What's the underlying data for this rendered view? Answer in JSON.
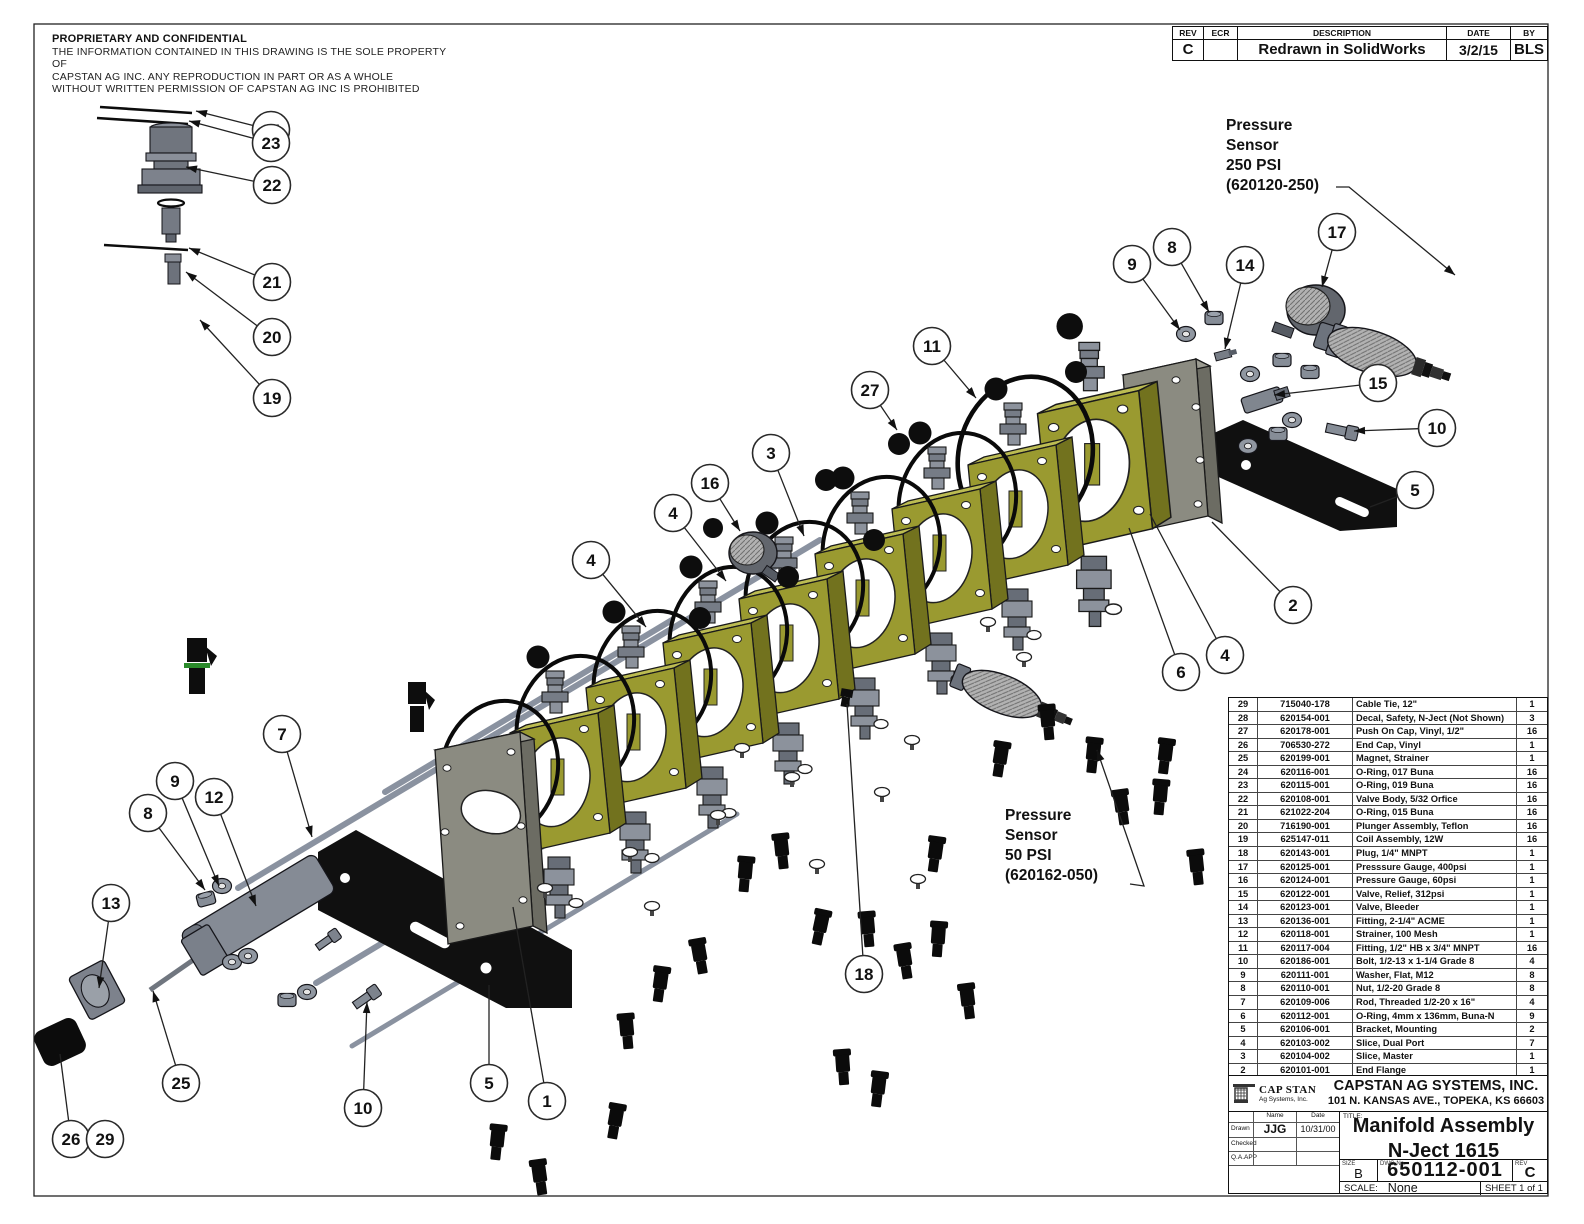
{
  "sheet": {
    "proprietary": {
      "title": "PROPRIETARY AND CONFIDENTIAL",
      "line1": "THE INFORMATION CONTAINED IN THIS DRAWING IS THE SOLE PROPERTY OF",
      "line2": "CAPSTAN AG INC. ANY REPRODUCTION IN PART OR AS A WHOLE",
      "line3": "WITHOUT WRITTEN PERMISSION OF CAPSTAN AG INC IS PROHIBITED"
    },
    "revision_table": {
      "headers": [
        "REV",
        "ECR",
        "DESCRIPTION",
        "DATE",
        "BY"
      ],
      "row": {
        "rev": "C",
        "ecr": "",
        "description": "Redrawn in SolidWorks",
        "date": "3/2/15",
        "by": "BLS"
      }
    },
    "labels": {
      "pressure_250": [
        "Pressure",
        "Sensor",
        "250 PSI",
        "(620120-250)"
      ],
      "pressure_50": [
        "Pressure",
        "Sensor",
        "50 PSI",
        "(620162-050)"
      ]
    },
    "bom": {
      "headers": [
        "Item",
        "Part Number",
        "Description",
        "Qty"
      ],
      "rows": [
        [
          "29",
          "715040-178",
          "Cable Tie, 12\"",
          "1"
        ],
        [
          "28",
          "620154-001",
          "Decal, Safety, N-Ject (Not Shown)",
          "3"
        ],
        [
          "27",
          "620178-001",
          "Push On Cap, Vinyl, 1/2\"",
          "16"
        ],
        [
          "26",
          "706530-272",
          "End Cap, Vinyl",
          "1"
        ],
        [
          "25",
          "620199-001",
          "Magnet, Strainer",
          "1"
        ],
        [
          "24",
          "620116-001",
          "O-Ring, 017 Buna",
          "16"
        ],
        [
          "23",
          "620115-001",
          "O-Ring, 019 Buna",
          "16"
        ],
        [
          "22",
          "620108-001",
          "Valve Body, 5/32 Orfice",
          "16"
        ],
        [
          "21",
          "621022-204",
          "O-Ring, 015 Buna",
          "16"
        ],
        [
          "20",
          "716190-001",
          "Plunger Assembly, Teflon",
          "16"
        ],
        [
          "19",
          "625147-011",
          "Coil Assembly, 12W",
          "16"
        ],
        [
          "18",
          "620143-001",
          "Plug, 1/4\" MNPT",
          "1"
        ],
        [
          "17",
          "620125-001",
          "Presssure Gauge, 400psi",
          "1"
        ],
        [
          "16",
          "620124-001",
          "Pressure Gauge, 60psi",
          "1"
        ],
        [
          "15",
          "620122-001",
          "Valve, Relief, 312psi",
          "1"
        ],
        [
          "14",
          "620123-001",
          "Valve, Bleeder",
          "1"
        ],
        [
          "13",
          "620136-001",
          "Fitting, 2-1/4\" ACME",
          "1"
        ],
        [
          "12",
          "620118-001",
          "Strainer, 100 Mesh",
          "1"
        ],
        [
          "11",
          "620117-004",
          "Fitting, 1/2\" HB x 3/4\" MNPT",
          "16"
        ],
        [
          "10",
          "620186-001",
          "Bolt, 1/2-13 x 1-1/4 Grade 8",
          "4"
        ],
        [
          "9",
          "620111-001",
          "Washer, Flat, M12",
          "8"
        ],
        [
          "8",
          "620110-001",
          "Nut, 1/2-20 Grade 8",
          "8"
        ],
        [
          "7",
          "620109-006",
          "Rod, Threaded 1/2-20 x 16\"",
          "4"
        ],
        [
          "6",
          "620112-001",
          "O-Ring, 4mm x 136mm, Buna-N",
          "9"
        ],
        [
          "5",
          "620106-001",
          "Bracket, Mounting",
          "2"
        ],
        [
          "4",
          "620103-002",
          "Slice, Dual Port",
          "7"
        ],
        [
          "3",
          "620104-002",
          "Slice, Master",
          "1"
        ],
        [
          "2",
          "620101-001",
          "End Flange",
          "1"
        ],
        [
          "1",
          "620100-001",
          "Inlet Flange",
          "1"
        ]
      ]
    },
    "title_block": {
      "logo_line1": "CAP STAN",
      "logo_line2": "Ag Systems, Inc.",
      "company": "CAPSTAN AG SYSTEMS, INC.",
      "address": "101 N. KANSAS AVE., TOPEKA, KS 66603",
      "name_col": "Name",
      "date_col": "Date",
      "sign_rows": [
        {
          "label": "Drawn",
          "name": "JJG",
          "date": "10/31/00"
        },
        {
          "label": "Checked",
          "name": "",
          "date": ""
        },
        {
          "label": "Q.A.APP",
          "name": "",
          "date": ""
        }
      ],
      "title_label": "TITLE:",
      "title_line1": "Manifold Assembly",
      "title_line2": "N-Ject 1615",
      "size_label": "SIZE",
      "size": "B",
      "dwg_label": "DWG No.",
      "dwg_no": "650112-001",
      "rev_label": "REV",
      "rev": "C",
      "scale_label": "SCALE:",
      "scale": "None",
      "sheet_label": "SHEET 1 of 1"
    },
    "colors": {
      "slice_face": "#9a9a30",
      "slice_top": "#bcbc52",
      "slice_side": "#72721e",
      "plate": "#8b8b81",
      "plate_side": "#6c6c63",
      "metal": "#8c929c",
      "metal_dark": "#676d77",
      "bracket": "#101010",
      "line": "#222222",
      "highlight_green": "#2a8a2a"
    },
    "balloons": [
      {
        "n": "24",
        "x": 271,
        "y": 130,
        "tx": 196,
        "ty": 111,
        "arrow": true
      },
      {
        "n": "23",
        "x": 271,
        "y": 143,
        "tx": 189,
        "ty": 121,
        "arrow": true
      },
      {
        "n": "22",
        "x": 272,
        "y": 185,
        "tx": 186,
        "ty": 167,
        "arrow": true
      },
      {
        "n": "21",
        "x": 272,
        "y": 282,
        "tx": 189,
        "ty": 248,
        "arrow": true
      },
      {
        "n": "20",
        "x": 272,
        "y": 337,
        "tx": 186,
        "ty": 272,
        "arrow": true
      },
      {
        "n": "19",
        "x": 272,
        "y": 398,
        "tx": 200,
        "ty": 320,
        "arrow": true
      },
      {
        "n": "9",
        "x": 1132,
        "y": 264,
        "tx": 1180,
        "ty": 330,
        "arrow": true
      },
      {
        "n": "8",
        "x": 1172,
        "y": 247,
        "tx": 1209,
        "ty": 312,
        "arrow": true
      },
      {
        "n": "14",
        "x": 1245,
        "y": 265,
        "tx": 1225,
        "ty": 349,
        "arrow": true
      },
      {
        "n": "17",
        "x": 1337,
        "y": 232,
        "tx": 1322,
        "ty": 287,
        "arrow": true
      },
      {
        "n": "15",
        "x": 1378,
        "y": 383,
        "tx": 1274,
        "ty": 395,
        "arrow": true
      },
      {
        "n": "10",
        "x": 1437,
        "y": 428,
        "tx": 1354,
        "ty": 431,
        "arrow": true
      },
      {
        "n": "5",
        "x": 1415,
        "y": 490,
        "tx": 1370,
        "ty": 507,
        "arrow": false
      },
      {
        "n": "11",
        "x": 932,
        "y": 346,
        "tx": 976,
        "ty": 398,
        "arrow": true
      },
      {
        "n": "27",
        "x": 870,
        "y": 390,
        "tx": 897,
        "ty": 430,
        "arrow": true
      },
      {
        "n": "3",
        "x": 771,
        "y": 453,
        "tx": 804,
        "ty": 536,
        "arrow": true
      },
      {
        "n": "16",
        "x": 710,
        "y": 483,
        "tx": 740,
        "ty": 531,
        "arrow": true
      },
      {
        "n": "4",
        "x": 673,
        "y": 513,
        "tx": 726,
        "ty": 581,
        "arrow": true
      },
      {
        "n": "4",
        "x": 591,
        "y": 560,
        "tx": 646,
        "ty": 627,
        "arrow": true
      },
      {
        "n": "2",
        "x": 1293,
        "y": 605,
        "tx": 1212,
        "ty": 522,
        "arrow": false
      },
      {
        "n": "4",
        "x": 1225,
        "y": 655,
        "tx": 1150,
        "ty": 514,
        "arrow": false
      },
      {
        "n": "6",
        "x": 1181,
        "y": 672,
        "tx": 1129,
        "ty": 528,
        "arrow": false
      },
      {
        "n": "7",
        "x": 282,
        "y": 734,
        "tx": 312,
        "ty": 837,
        "arrow": true
      },
      {
        "n": "9",
        "x": 175,
        "y": 781,
        "tx": 219,
        "ty": 886,
        "arrow": true
      },
      {
        "n": "12",
        "x": 214,
        "y": 797,
        "tx": 256,
        "ty": 906,
        "arrow": true
      },
      {
        "n": "8",
        "x": 148,
        "y": 813,
        "tx": 205,
        "ty": 890,
        "arrow": true
      },
      {
        "n": "13",
        "x": 111,
        "y": 903,
        "tx": 99,
        "ty": 988,
        "arrow": true
      },
      {
        "n": "25",
        "x": 181,
        "y": 1083,
        "tx": 153,
        "ty": 991,
        "arrow": true
      },
      {
        "n": "10",
        "x": 363,
        "y": 1108,
        "tx": 367,
        "ty": 1002,
        "arrow": true
      },
      {
        "n": "5",
        "x": 489,
        "y": 1083,
        "tx": 489,
        "ty": 985,
        "arrow": false
      },
      {
        "n": "1",
        "x": 547,
        "y": 1101,
        "tx": 513,
        "ty": 907,
        "arrow": false
      },
      {
        "n": "26",
        "x": 71,
        "y": 1139,
        "tx": 60,
        "ty": 1054,
        "arrow": false
      },
      {
        "n": "29",
        "x": 105,
        "y": 1139,
        "leader": false
      },
      {
        "n": "18",
        "x": 864,
        "y": 974,
        "tx": 847,
        "ty": 704,
        "arrow": false
      }
    ]
  }
}
